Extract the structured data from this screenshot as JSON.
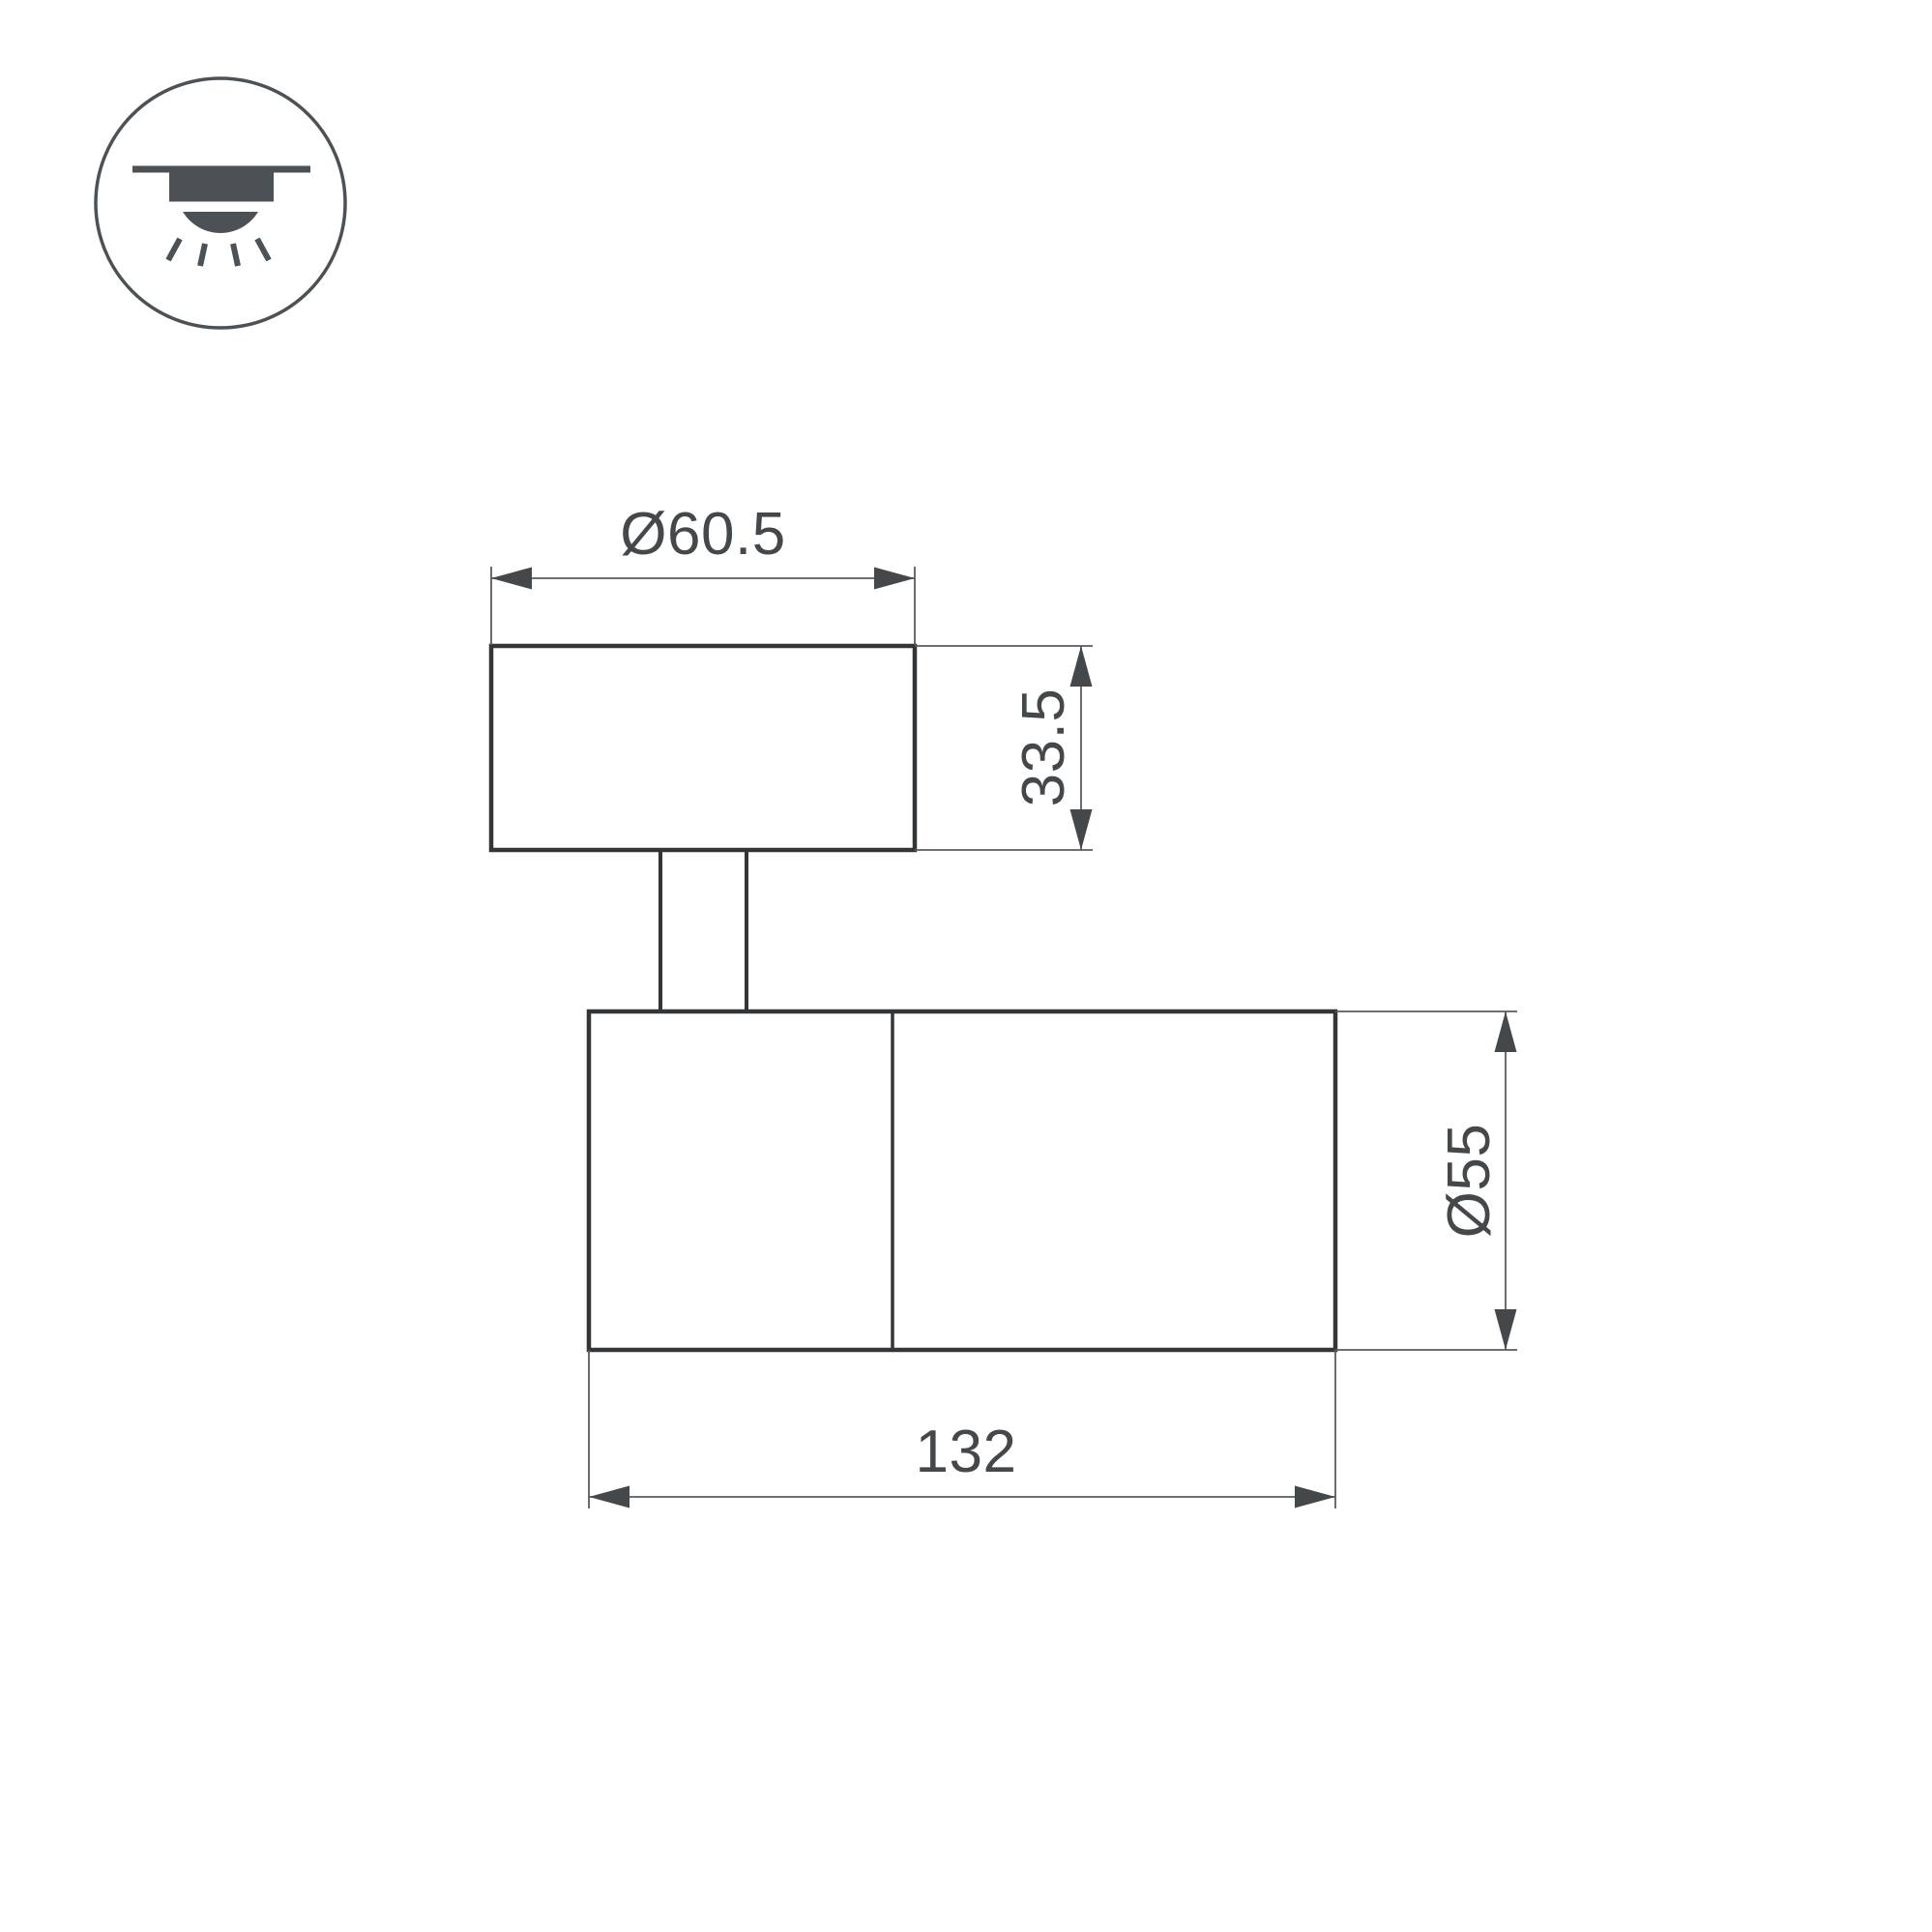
{
  "icon": {
    "name": "surface-ceiling-mount-light-icon"
  },
  "dimensions": {
    "top_diameter": "Ø60.5",
    "base_height": "33.5",
    "body_diameter": "Ø55",
    "body_length": "132"
  },
  "colors": {
    "background": "#ffffff",
    "outline": "#333639",
    "dimension_line": "#595c5f",
    "text": "#45484b",
    "icon": "#4c5156"
  }
}
